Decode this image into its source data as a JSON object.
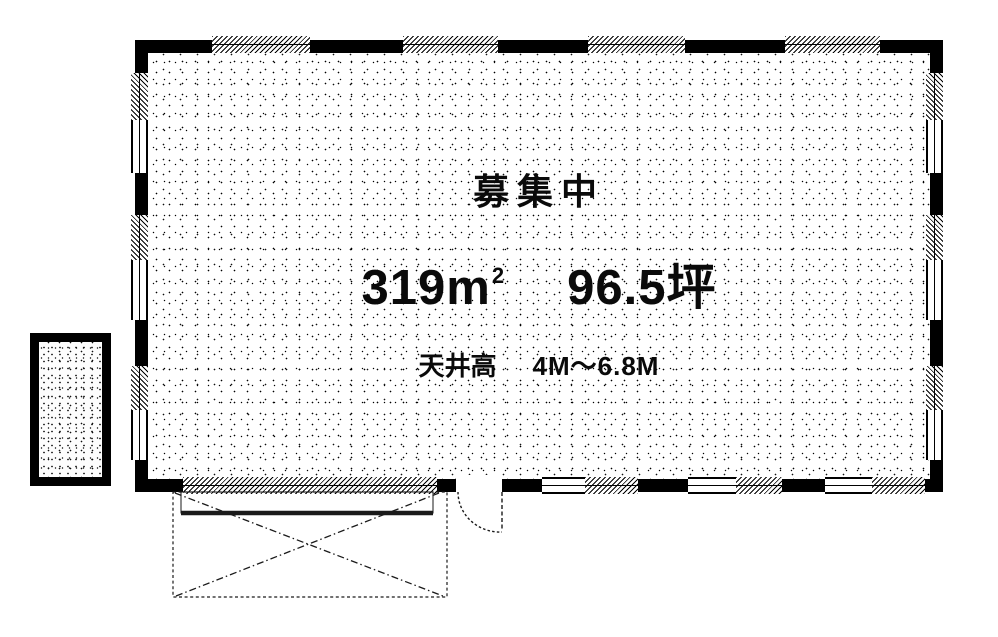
{
  "plan": {
    "status": "募集中",
    "area": {
      "sqm": "319m",
      "sqm_sup": "2",
      "tsubo": "96.5坪"
    },
    "ceiling": {
      "label": "天井高",
      "value": "4M～6.8M"
    },
    "icons": {
      "door_symbol": "door-swing-arc",
      "dock_symbol": "x-cross-platform",
      "window_symbol": "hatched-window-segment"
    },
    "colors": {
      "wall": "#000000",
      "background": "#ffffff",
      "line": "#1a1a1a"
    }
  }
}
